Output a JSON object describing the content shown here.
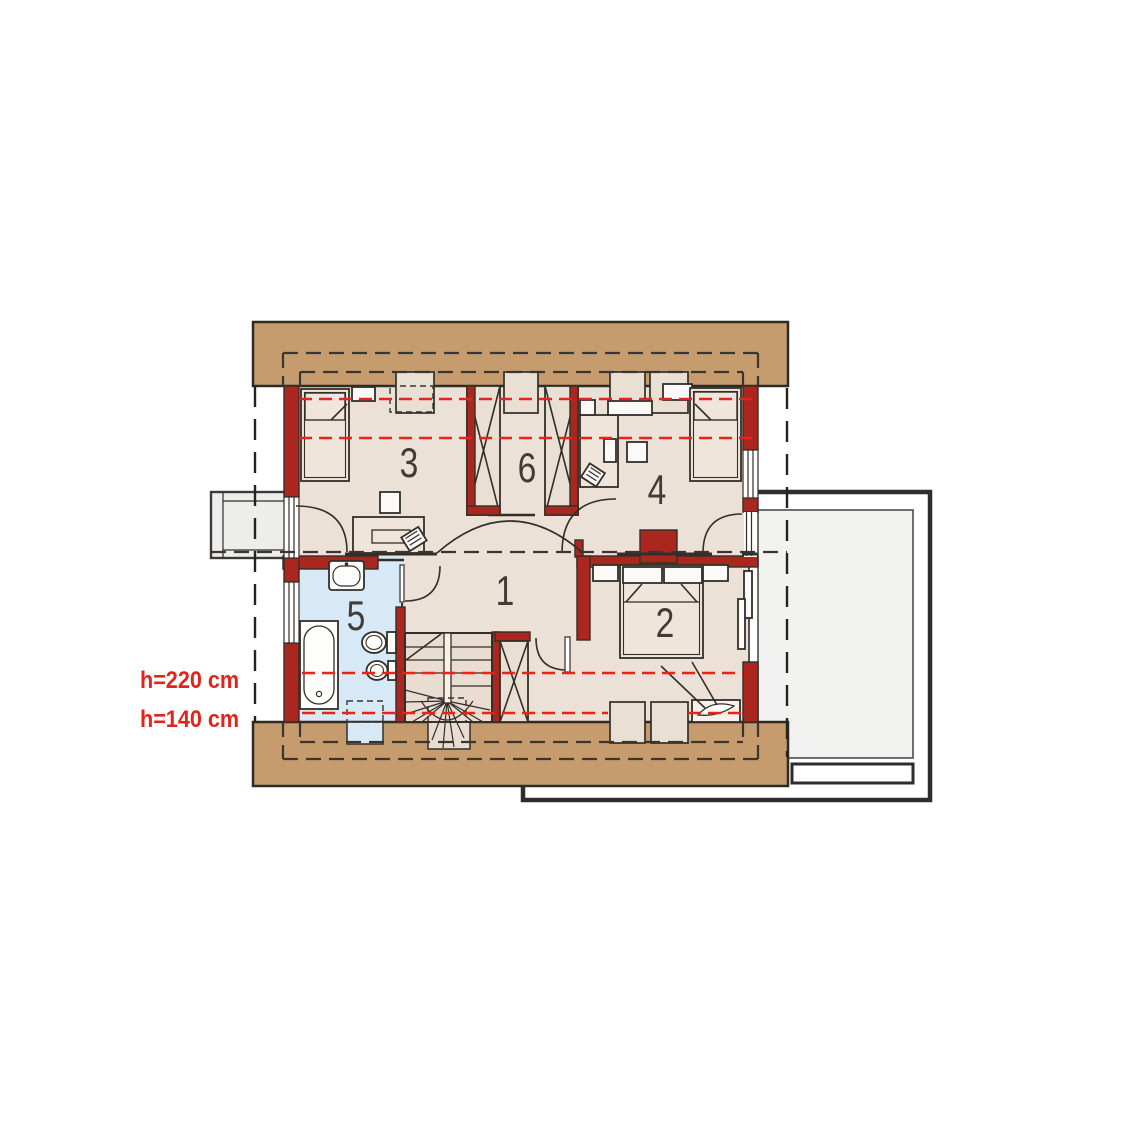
{
  "plan": {
    "room_numbers": {
      "r1": "1",
      "r2": "2",
      "r3": "3",
      "r4": "4",
      "r5": "5",
      "r6": "6"
    },
    "annotations": {
      "h220": "h=220 cm",
      "h140": "h=140 cm"
    }
  },
  "colors": {
    "wall_red": "#ac2620",
    "height_line_red": "#e8231c",
    "annotation_red": "#e0251c",
    "roof_band_brown": "#c69b6d",
    "floor_beige": "#ece1d7",
    "bathroom_blue": "#d7e9f6",
    "terrace_gray": "#f2f2f1",
    "outline_dark": "#332e29",
    "room_number_gray": "#413c38"
  }
}
